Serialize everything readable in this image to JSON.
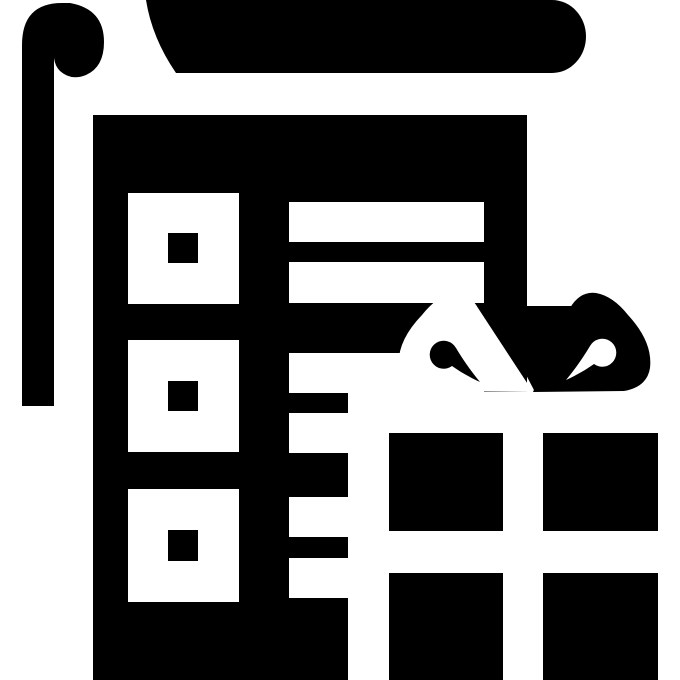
{
  "icon": {
    "title": "wrapping-paper-and-gift-icon",
    "description": "Black glyph icon of a roll of wrapping paper with a curled end, a patterned sheet (squares with dots and horizontal stripes), and a gift box with a ribbon bow",
    "colors": {
      "ink": "#000000",
      "background": "#ffffff"
    },
    "parts": {
      "roll": "paper-roll",
      "curl": "paper-curl",
      "sheet": "wrapping-sheet",
      "squares": "square-pattern",
      "stripes": "stripe-pattern",
      "bow": "ribbon-bow",
      "box": "gift-box"
    }
  }
}
